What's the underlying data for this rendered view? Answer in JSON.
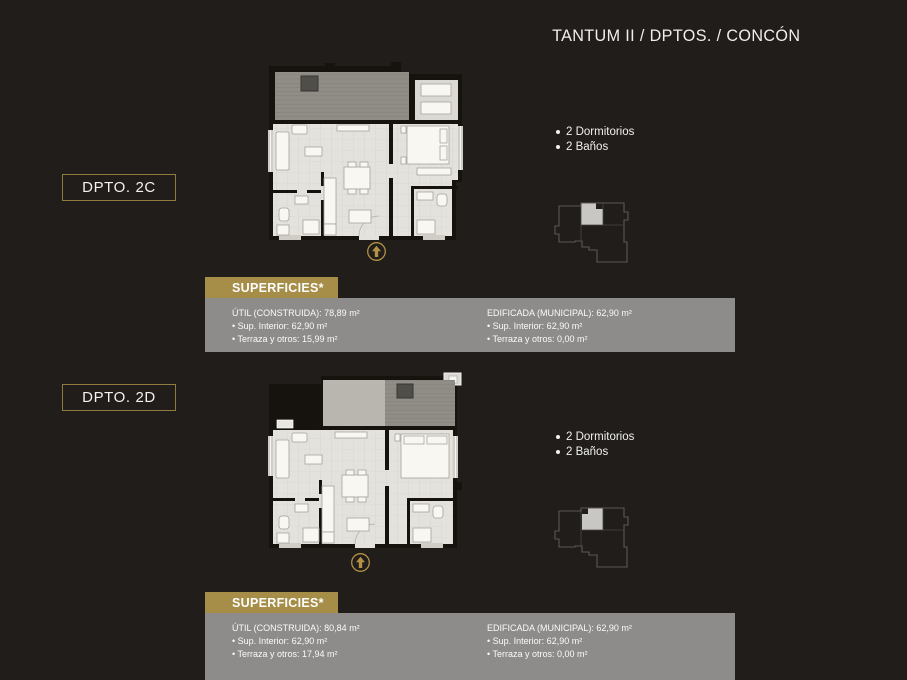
{
  "title": "TANTUM II / DPTOS. / CONCÓN",
  "colors": {
    "background": "#201d1b",
    "gold_accent": "#a68e49",
    "label_border_gold": "#8f7a3f",
    "gray_panel": "#8d8c8a",
    "text": "#f2f1ee",
    "keyplan_highlight": "#c8c7c4"
  },
  "sections": [
    {
      "label": "DPTO. 2C",
      "features": [
        "2 Dormitorios",
        "2 Baños"
      ],
      "superficies_header": "SUPERFICIES*",
      "util_title": "ÚTIL (CONSTRUIDA): 78,89 m²",
      "util_items": [
        "Sup. Interior: 62,90 m²",
        "Terraza y otros: 15,99 m²"
      ],
      "edificada_title": "EDIFICADA (MUNICIPAL): 62,90 m²",
      "edificada_items": [
        "Sup. Interior: 62,90 m²",
        "Terraza y otros: 0,00 m²"
      ]
    },
    {
      "label": "DPTO. 2D",
      "features": [
        "2 Dormitorios",
        "2 Baños"
      ],
      "superficies_header": "SUPERFICIES*",
      "util_title": "ÚTIL (CONSTRUIDA): 80,84 m²",
      "util_items": [
        "Sup. Interior: 62,90 m²",
        "Terraza y otros: 17,94 m²"
      ],
      "edificada_title": "EDIFICADA (MUNICIPAL): 62,90 m²",
      "edificada_items": [
        "Sup. Interior: 62,90 m²",
        "Terraza y otros: 0,00 m²"
      ]
    }
  ]
}
